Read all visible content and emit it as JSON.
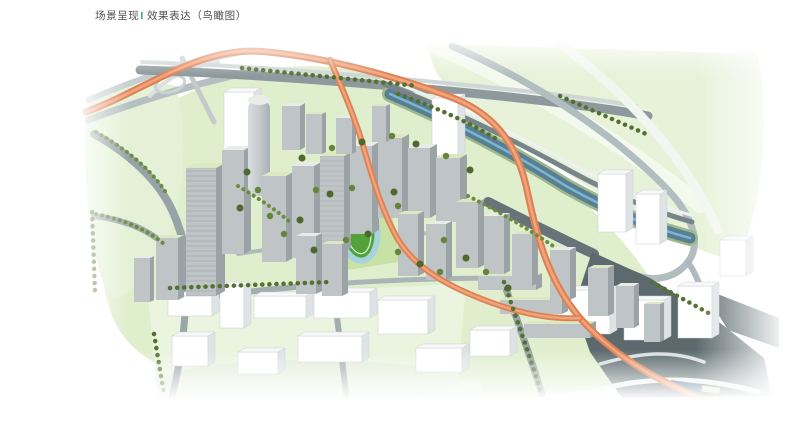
{
  "header": {
    "title_prefix": "场景呈现",
    "title_separator": "I",
    "title_suffix": "效果表达（鸟瞰图）"
  },
  "colors": {
    "background": "#FFFFFF",
    "title_text": "#4F4F4F",
    "separator_green": "#3BA878",
    "expressway_orange": "#DE8053",
    "ground_green": "#DFEECC",
    "field_green": "#53A23A",
    "track_blue": "#A6D4DE",
    "court_blue": "#7AB3CC",
    "river_blue": "#4E80A0",
    "tree_green": "#54702F",
    "road_gray": "#97A3A7",
    "dark_road_gray": "#5C6A6E",
    "tower_gray": "#BFC4C7",
    "tower_side_gray": "#9CA3A7",
    "roof_green": "#DBE8C2",
    "massing_white": "#FFFFFF"
  }
}
